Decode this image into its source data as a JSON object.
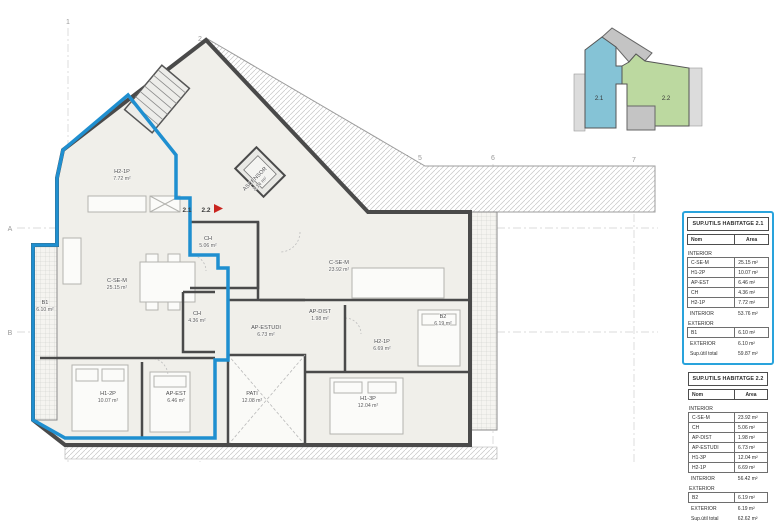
{
  "plan": {
    "unit_labels": [
      {
        "text": "2.1"
      },
      {
        "text": "2.2"
      }
    ],
    "rooms": [
      {
        "name": "H2-1P",
        "area": "7.72 m²",
        "x": 122,
        "y": 173
      },
      {
        "name": "ASCENSOR",
        "area": "2.14 m²",
        "x": 256,
        "y": 180,
        "rot": -45
      },
      {
        "name": "C-SE-M",
        "area": "25.15 m²",
        "x": 117,
        "y": 282
      },
      {
        "name": "C-SE-M",
        "area": "23.92 m²",
        "x": 339,
        "y": 264
      },
      {
        "name": "CH",
        "area": "5.06 m²",
        "x": 208,
        "y": 240
      },
      {
        "name": "CH",
        "area": "4.36 m²",
        "x": 197,
        "y": 315
      },
      {
        "name": "AP-DIST",
        "area": "1.98 m²",
        "x": 320,
        "y": 313
      },
      {
        "name": "AP-ESTUDI",
        "area": "6.73 m²",
        "x": 266,
        "y": 329
      },
      {
        "name": "H2-1P",
        "area": "6.69 m²",
        "x": 382,
        "y": 343
      },
      {
        "name": "H1-2P",
        "area": "10.07 m²",
        "x": 108,
        "y": 395
      },
      {
        "name": "AP-EST",
        "area": "6.46 m²",
        "x": 176,
        "y": 395
      },
      {
        "name": "PATI",
        "area": "12.08 m²",
        "x": 252,
        "y": 395
      },
      {
        "name": "H1-3P",
        "area": "12.04 m²",
        "x": 368,
        "y": 400
      },
      {
        "name": "B1",
        "area": "6.10 m²",
        "x": 45,
        "y": 304
      },
      {
        "name": "B2",
        "area": "6.19 m²",
        "x": 443,
        "y": 318
      }
    ],
    "grid": [
      {
        "label": "1",
        "tx": 68,
        "ty": 24,
        "x1": 68,
        "y1": 28,
        "x2": 68,
        "y2": 462
      },
      {
        "label": "2",
        "tx": 200,
        "ty": 41,
        "x1": 200,
        "y1": 45,
        "x2": 200,
        "y2": 462
      },
      {
        "label": "4",
        "tx": 407,
        "ty": 160,
        "x1": 407,
        "y1": 164,
        "x2": 407,
        "y2": 462
      },
      {
        "label": "5",
        "tx": 420,
        "ty": 160,
        "x1": 420,
        "y1": 164,
        "x2": 420,
        "y2": 462
      },
      {
        "label": "6",
        "tx": 493,
        "ty": 160,
        "x1": 493,
        "y1": 164,
        "x2": 493,
        "y2": 462
      },
      {
        "label": "7",
        "tx": 634,
        "ty": 162,
        "x1": 634,
        "y1": 166,
        "x2": 634,
        "y2": 462
      },
      {
        "label": "A",
        "tx": 10,
        "ty": 231,
        "x1": 17,
        "y1": 228,
        "x2": 658,
        "y2": 228
      },
      {
        "label": "B",
        "tx": 10,
        "ty": 335,
        "x1": 17,
        "y1": 332,
        "x2": 658,
        "y2": 332
      }
    ]
  },
  "keyplan": {
    "units": [
      {
        "id": "2.1"
      },
      {
        "id": "2.2"
      }
    ]
  },
  "tables": [
    {
      "title": "SUP.UTILS HABITATGE 2.1",
      "col_name": "Nom",
      "col_area": "Area",
      "rows": [
        {
          "type": "section",
          "label": "INTERIOR"
        },
        {
          "type": "row",
          "label": "C-SE-M",
          "value": "25.15 m²"
        },
        {
          "type": "row",
          "label": "H1-2P",
          "value": "10.07 m²"
        },
        {
          "type": "row",
          "label": "AP-EST",
          "value": "6.46 m²"
        },
        {
          "type": "row",
          "label": "CH",
          "value": "4.36 m²"
        },
        {
          "type": "row",
          "label": "H2-1P",
          "value": "7.72 m²"
        },
        {
          "type": "subtotal",
          "label": "INTERIOR",
          "value": "53.76 m²"
        },
        {
          "type": "section",
          "label": "EXTERIOR"
        },
        {
          "type": "row",
          "label": "B1",
          "value": "6.10 m²"
        },
        {
          "type": "subtotal",
          "label": "EXTERIOR",
          "value": "6.10 m²"
        },
        {
          "type": "total",
          "label": "Sup.útil total",
          "value": "59.87 m²"
        }
      ]
    },
    {
      "title": "SUP.UTILS HABITATGE 2.2",
      "col_name": "Nom",
      "col_area": "Area",
      "rows": [
        {
          "type": "section",
          "label": "INTERIOR"
        },
        {
          "type": "row",
          "label": "C-SE-M",
          "value": "23.92 m²"
        },
        {
          "type": "row",
          "label": "CH",
          "value": "5.06 m²"
        },
        {
          "type": "row",
          "label": "AP-DIST",
          "value": "1.98 m²"
        },
        {
          "type": "row",
          "label": "AP-ESTUDI",
          "value": "6.73 m²"
        },
        {
          "type": "row",
          "label": "H1-3P",
          "value": "12.04 m²"
        },
        {
          "type": "row",
          "label": "H2-1P",
          "value": "6.69 m²"
        },
        {
          "type": "subtotal",
          "label": "INTERIOR",
          "value": "56.42 m²"
        },
        {
          "type": "section",
          "label": "EXTERIOR"
        },
        {
          "type": "row",
          "label": "B2",
          "value": "6.19 m²"
        },
        {
          "type": "subtotal",
          "label": "EXTERIOR",
          "value": "6.19 m²"
        },
        {
          "type": "total",
          "label": "Sup.útil total",
          "value": "62.62 m²"
        }
      ]
    }
  ],
  "colors": {
    "apartment_outline_blue": "#1f8fd0",
    "table_border_blue": "#29a3dc",
    "keyplan_unit_21": "#85c3d6",
    "keyplan_unit_22": "#bcd9a0",
    "entry_arrow_red": "#c9251f",
    "walls": "#4a4a4a"
  }
}
